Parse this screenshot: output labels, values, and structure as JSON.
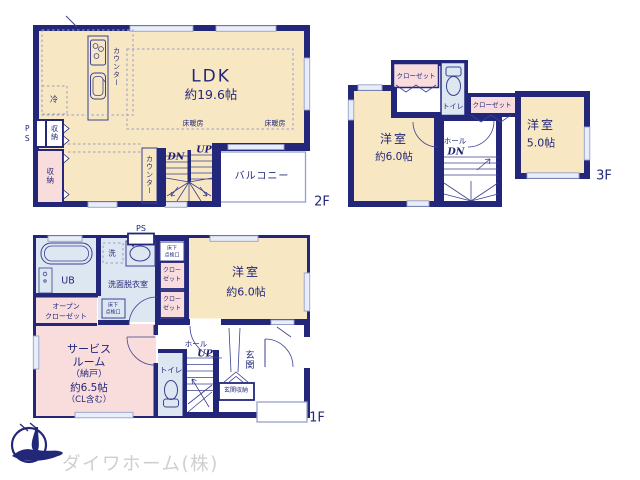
{
  "colors": {
    "wall": "#23277a",
    "room_cream": "#f7e7c2",
    "closet_pink": "#f9dcdc",
    "wet_blue": "#dde7f2",
    "logo_navy": "#23277a",
    "logo_text_gray": "#cfcfcf"
  },
  "floor2": {
    "floor_label": "2F",
    "ldk_name": "LDK",
    "ldk_size": "約19.6帖",
    "floor_heating_left": "床暖房",
    "floor_heating_right": "床暖房",
    "kitchen_counter": "カウンター",
    "stairs_counter": "カウンター",
    "fridge": "冷",
    "pipe_space": "PS",
    "storage_upper": "収納",
    "storage_lower": "収納",
    "stairs_down": "DN",
    "stairs_up": "UP",
    "balcony": "バルコニー"
  },
  "floor3": {
    "floor_label": "3F",
    "closet_left": "クローゼット",
    "closet_right": "クローゼット",
    "toilet": "トイレ",
    "room_left_name": "洋室",
    "room_left_size": "約6.0帖",
    "room_right_name": "洋室",
    "room_right_size": "5.0帖",
    "hall": "ホール",
    "stairs_down": "DN"
  },
  "floor1": {
    "floor_label": "1F",
    "pipe_space": "PS",
    "unit_bath": "UB",
    "washer": "洗",
    "washroom": "洗面脱衣室",
    "hatch_top": {
      "l1": "床下",
      "l2": "点検口"
    },
    "hatch_bottom": {
      "l1": "床下",
      "l2": "点検口"
    },
    "closet_top": {
      "l1": "クロー",
      "l2": "ゼット"
    },
    "closet_bottom": {
      "l1": "クロー",
      "l2": "ゼット"
    },
    "room": {
      "name": "洋室",
      "size": "約6.0帖"
    },
    "open_closet": {
      "l1": "オープン",
      "l2": "クローゼット"
    },
    "service": {
      "l1": "サービス",
      "l2": "ルーム",
      "l3": "（納戸）",
      "l4": "約6.5帖",
      "l5": "（CL含む）"
    },
    "hall": "ホール",
    "stairs_up": "UP",
    "toilet": "トイレ",
    "entrance": "玄関",
    "entrance_storage": "玄関収納"
  },
  "footer": {
    "company": "ダイワホーム(株)"
  }
}
